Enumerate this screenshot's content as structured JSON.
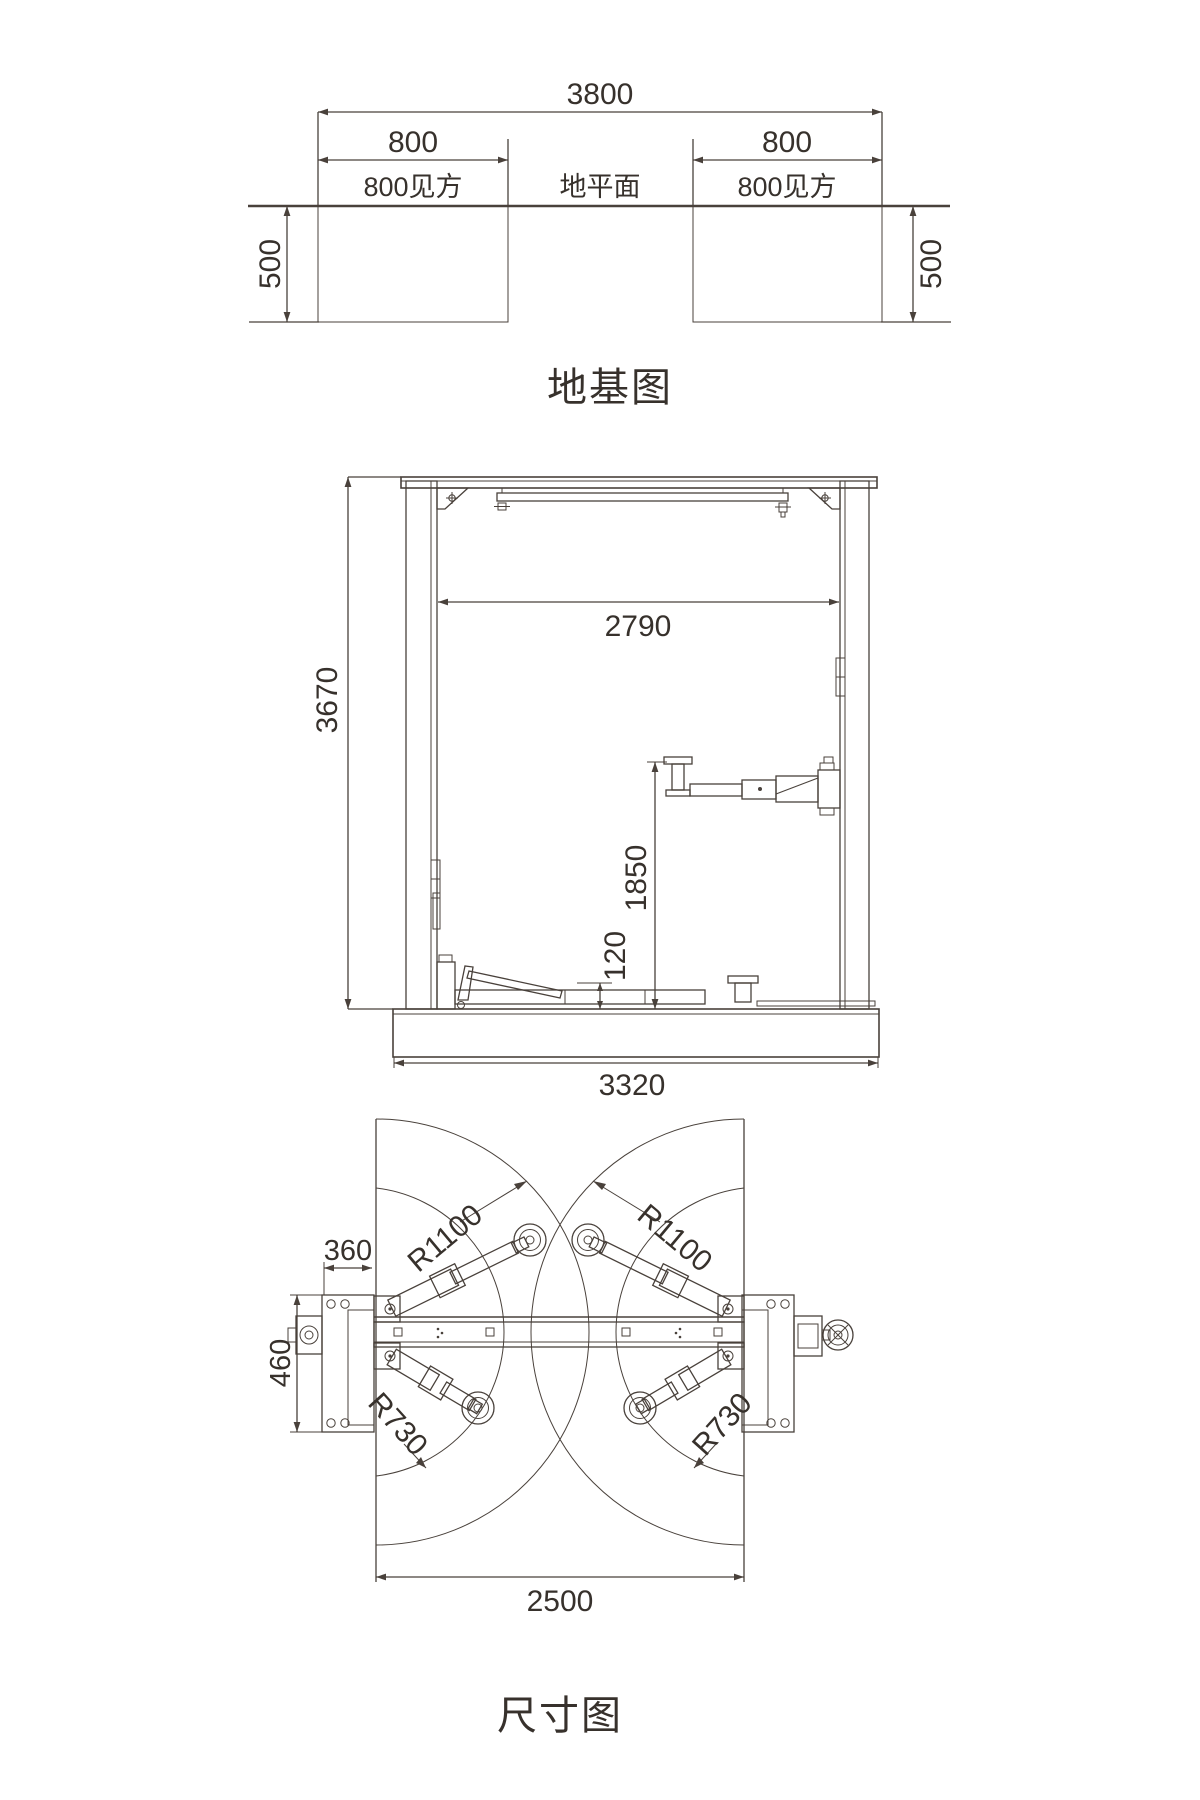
{
  "foundation": {
    "title": "地基图",
    "total_width": "3800",
    "pad_width_left": "800",
    "pad_width_right": "800",
    "pad_note_left": "800见方",
    "ground_label": "地平面",
    "pad_note_right": "800见方",
    "depth_left": "500",
    "depth_right": "500"
  },
  "elevation": {
    "inner_width": "2790",
    "total_height": "3670",
    "arm_raised_height": "1850",
    "arm_lowered_height": "120",
    "base_width": "3320"
  },
  "plan": {
    "title": "尺寸图",
    "front_arm_radius_left": "R1100",
    "front_arm_radius_right": "R1100",
    "rear_arm_radius_left": "R730",
    "rear_arm_radius_right": "R730",
    "side_offset": "360",
    "plate_depth": "460",
    "drive_width": "2500"
  },
  "colors": {
    "line": "#49413b",
    "text": "#37312c",
    "background": "#ffffff"
  }
}
